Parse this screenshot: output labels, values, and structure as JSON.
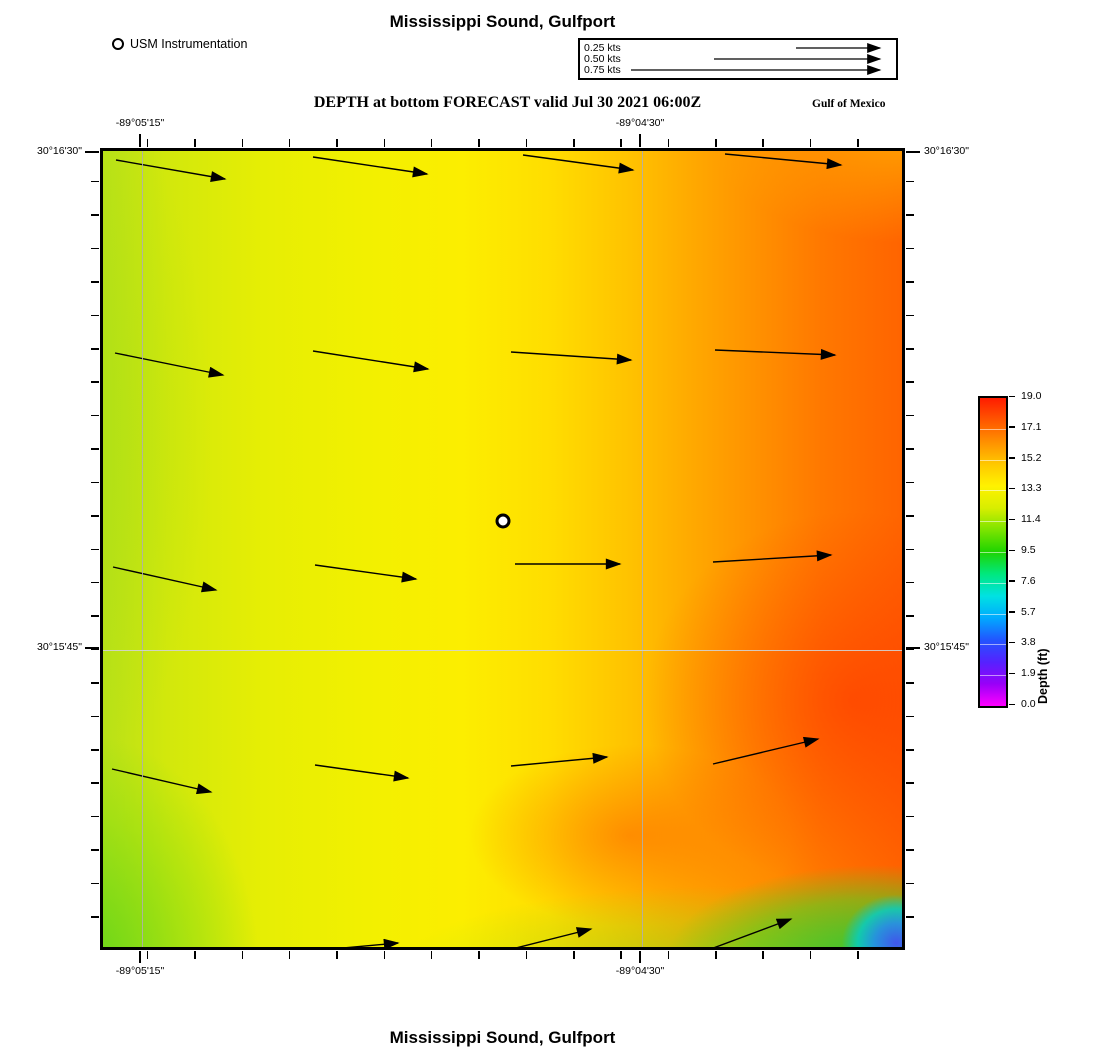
{
  "header": {
    "title": "Mississippi Sound, Gulfport",
    "station_legend_label": "USM Instrumentation",
    "subtitle": "DEPTH at bottom FORECAST valid Jul 30 2021 06:00Z",
    "region_label": "Gulf of Mexico",
    "speed_legend": {
      "entries": [
        {
          "label": "0.25 kts",
          "arrow_px": 90
        },
        {
          "label": "0.50 kts",
          "arrow_px": 172
        },
        {
          "label": "0.75 kts",
          "arrow_px": 255
        }
      ]
    }
  },
  "footer": {
    "title": "Mississippi Sound, Gulfport"
  },
  "chart_data": {
    "type": "heatmap",
    "subtype": "ocean model forecast map with current vector field",
    "title": "Mississippi Sound, Gulfport",
    "subtitle": "DEPTH at bottom FORECAST valid Jul 30 2021 06:00Z",
    "region": "Gulf of Mexico",
    "valid_time": "Jul 30 2021 06:00Z",
    "x_axis": {
      "label": "longitude",
      "tick_labels": [
        "-89°05'15\"",
        "-89°04'30\""
      ],
      "tick_px": [
        40,
        540
      ],
      "minor_tick_intervals": 17
    },
    "y_axis": {
      "label": "latitude",
      "tick_labels": [
        "30°16'30\"",
        "30°15'45\""
      ],
      "tick_px": [
        4,
        500
      ],
      "minor_tick_intervals": 24
    },
    "colorbar": {
      "label": "Depth (ft)",
      "min": 0.0,
      "max": 19.0,
      "tick_values": [
        "19.0",
        "17.1",
        "15.2",
        "13.3",
        "11.4",
        "9.5",
        "7.6",
        "5.7",
        "3.8",
        "1.9",
        "0.0"
      ],
      "gradient_bottom_to_top": [
        "#ff00ff",
        "#9900f8",
        "#5522ff",
        "#2255ff",
        "#00aaff",
        "#00e2e2",
        "#00e87e",
        "#1ed400",
        "#7ce400",
        "#d8ee00",
        "#fff200",
        "#ffc800",
        "#ff9000",
        "#ff5600",
        "#ff1c00"
      ]
    },
    "field_description": "Bottom depth shaded from ~13-14 ft (yellow-green, west side) increasing eastward to ~18-19 ft (red-orange, east side); shallow patch (~2-10 ft, green to blue) in the extreme southeast corner",
    "station": {
      "label": "USM Instrumentation",
      "x_px": 400,
      "y_px": 370
    },
    "vector_units": "kts",
    "vectors": [
      {
        "x1": 13,
        "y1": 9,
        "x2": 122,
        "y2": 28,
        "speed_kts": 0.3
      },
      {
        "x1": 210,
        "y1": 6,
        "x2": 324,
        "y2": 23,
        "speed_kts": 0.3
      },
      {
        "x1": 420,
        "y1": 4,
        "x2": 530,
        "y2": 19,
        "speed_kts": 0.3
      },
      {
        "x1": 622,
        "y1": 3,
        "x2": 738,
        "y2": 14,
        "speed_kts": 0.3
      },
      {
        "x1": 12,
        "y1": 202,
        "x2": 120,
        "y2": 224,
        "speed_kts": 0.3
      },
      {
        "x1": 210,
        "y1": 200,
        "x2": 325,
        "y2": 218,
        "speed_kts": 0.3
      },
      {
        "x1": 408,
        "y1": 201,
        "x2": 528,
        "y2": 209,
        "speed_kts": 0.3
      },
      {
        "x1": 612,
        "y1": 199,
        "x2": 732,
        "y2": 204,
        "speed_kts": 0.3
      },
      {
        "x1": 10,
        "y1": 416,
        "x2": 113,
        "y2": 439,
        "speed_kts": 0.3
      },
      {
        "x1": 212,
        "y1": 414,
        "x2": 313,
        "y2": 428,
        "speed_kts": 0.3
      },
      {
        "x1": 412,
        "y1": 413,
        "x2": 517,
        "y2": 413,
        "speed_kts": 0.3
      },
      {
        "x1": 610,
        "y1": 411,
        "x2": 728,
        "y2": 404,
        "speed_kts": 0.3
      },
      {
        "x1": 9,
        "y1": 618,
        "x2": 108,
        "y2": 641,
        "speed_kts": 0.3
      },
      {
        "x1": 212,
        "y1": 614,
        "x2": 305,
        "y2": 627,
        "speed_kts": 0.25
      },
      {
        "x1": 408,
        "y1": 615,
        "x2": 504,
        "y2": 606,
        "speed_kts": 0.25
      },
      {
        "x1": 610,
        "y1": 613,
        "x2": 715,
        "y2": 588,
        "speed_kts": 0.3
      },
      {
        "x1": 240,
        "y1": 797,
        "x2": 295,
        "y2": 792,
        "speed_kts": 0.15
      },
      {
        "x1": 405,
        "y1": 799,
        "x2": 488,
        "y2": 778,
        "speed_kts": 0.25
      },
      {
        "x1": 605,
        "y1": 799,
        "x2": 688,
        "y2": 768,
        "speed_kts": 0.25
      }
    ]
  }
}
